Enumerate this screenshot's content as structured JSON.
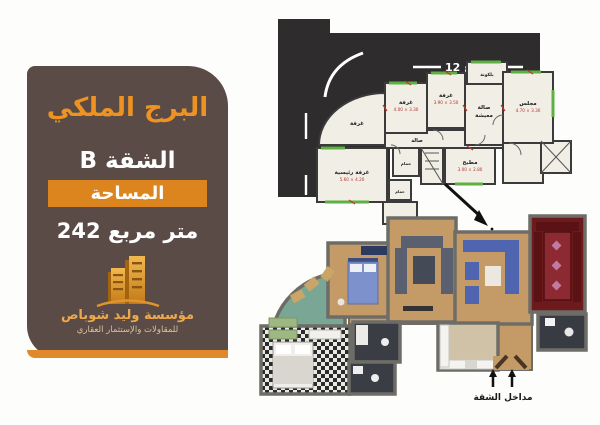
{
  "panel": {
    "title": "البرج الملكي",
    "apartment": "الشقة B",
    "area_label": "المساحة",
    "area_value": "242 متر مربع",
    "company_name": "مؤسسة وليد شوباص",
    "company_tagline": "للمقاولات والإستثمار العقاري"
  },
  "plan2d": {
    "street_top": "شارع 12",
    "street_left": "شارع 24",
    "rooms": {
      "balcony": "بلكونة",
      "bedroom1": {
        "label": "غرفة",
        "dim": "4.00 × 3.30"
      },
      "bedroom2": {
        "label": "غرفة",
        "dim": "3.90 × 3.50"
      },
      "living_line1": "صالة",
      "living_line2": "معيشة",
      "majlis": {
        "label": "مجلس",
        "dim": "4.70 × 3.30"
      },
      "bedroom3": "غرفة",
      "master": {
        "label": "غرفة رئيسية",
        "dim": "5.60 × 4.20"
      },
      "hall": "صالة",
      "bath1": "حمام",
      "kitchen": {
        "label": "مطبخ",
        "dim": "3.00 × 2.80"
      },
      "bath2": "حمام"
    }
  },
  "plan3d": {
    "entrance_label": "مداخل الشقة"
  },
  "colors": {
    "panel_bg": "#5a4b46",
    "accent_orange": "#e0882a",
    "title_orange": "#ee9322",
    "street_black": "#2e2c2d",
    "window_green": "#5fb043",
    "dimension_red": "#b5342a",
    "majlis_red": "#6d1a1d",
    "wood_floor": "#c49a66",
    "terrace_teal": "#7aa795"
  }
}
